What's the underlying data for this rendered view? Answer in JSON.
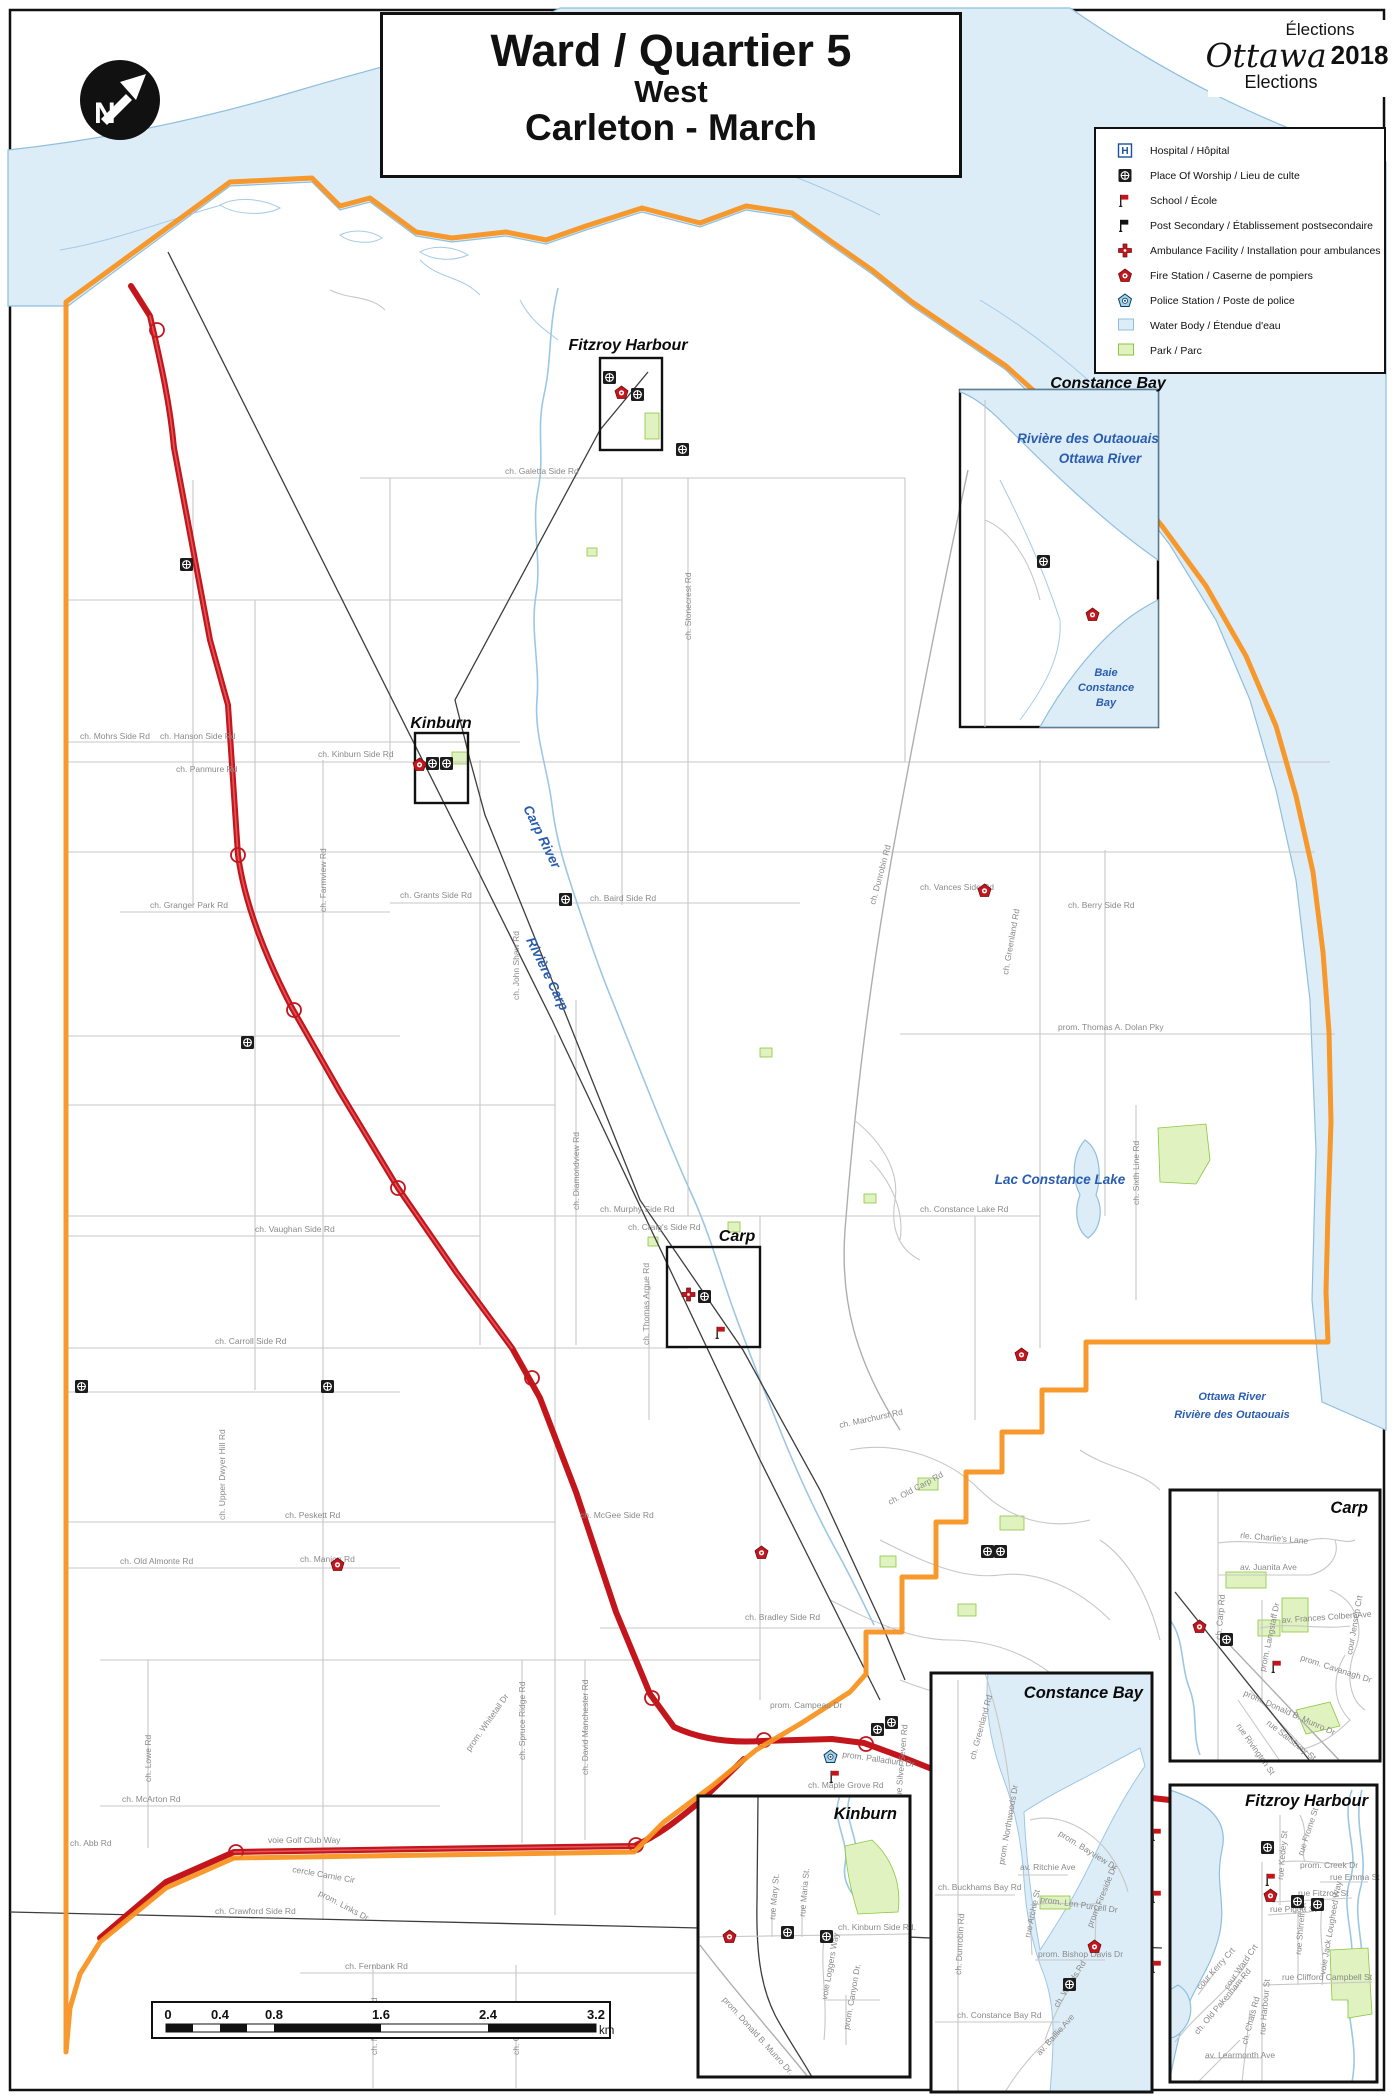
{
  "title": {
    "line1": "Ward / Quartier 5",
    "line2": "West",
    "line3": "Carleton - March"
  },
  "logo": {
    "elections_fr": "Élections",
    "brand": "Ottawa",
    "year": "2018",
    "elections_en": "Elections"
  },
  "legend": {
    "items": [
      {
        "id": "hospital",
        "label": "Hospital / Hôpital"
      },
      {
        "id": "worship",
        "label": "Place Of Worship / Lieu de culte"
      },
      {
        "id": "school",
        "label": "School / École"
      },
      {
        "id": "postsecondary",
        "label": "Post Secondary / Établissement postsecondaire"
      },
      {
        "id": "ambulance",
        "label": "Ambulance Facility / Installation pour ambulances"
      },
      {
        "id": "fire",
        "label": "Fire Station / Caserne de pompiers"
      },
      {
        "id": "police",
        "label": "Police Station / Poste de police"
      },
      {
        "id": "waterbody",
        "label": "Water Body / Étendue d'eau"
      },
      {
        "id": "park",
        "label": "Park / Parc"
      }
    ]
  },
  "scale_bar": {
    "ticks": [
      "0",
      "0.4",
      "0.8",
      "1.6",
      "2.4",
      "3.2"
    ],
    "unit": "km"
  },
  "colors": {
    "ward_boundary": "#F79421",
    "highway": "#C3161C",
    "water_fill": "#DCEDF8",
    "water_line": "#8FBFDD",
    "park_fill": "#DFF2BF",
    "park_stroke": "#8CC63F",
    "water_label": "#2A5CAF",
    "road_label": "#8a8a8a"
  },
  "map": {
    "settlement_labels": [
      {
        "t": "Fitzroy Harbour",
        "x": 628,
        "y": 350,
        "a": "middle"
      },
      {
        "t": "Constance Bay",
        "x": 1108,
        "y": 388,
        "a": "middle"
      },
      {
        "t": "Kinburn",
        "x": 441,
        "y": 728,
        "a": "middle"
      },
      {
        "t": "Carp",
        "x": 737,
        "y": 1241,
        "a": "middle"
      }
    ],
    "water_labels": [
      {
        "t": "Rivière des Outaouais",
        "x": 1088,
        "y": 443,
        "c": "wl-md",
        "a": "middle"
      },
      {
        "t": "Ottawa River",
        "x": 1100,
        "y": 463,
        "c": "wl-md",
        "a": "middle"
      },
      {
        "t": "Baie",
        "x": 1106,
        "y": 676,
        "c": "wl-sm",
        "a": "middle"
      },
      {
        "t": "Constance",
        "x": 1106,
        "y": 691,
        "c": "wl-sm",
        "a": "middle"
      },
      {
        "t": "Bay",
        "x": 1106,
        "y": 706,
        "c": "wl-sm",
        "a": "middle"
      },
      {
        "t": "Carp River",
        "x": 523,
        "y": 808,
        "c": "wl-md",
        "r": 64
      },
      {
        "t": "Rivière Carp",
        "x": 526,
        "y": 940,
        "c": "wl-md",
        "r": 64
      },
      {
        "t": "Lac  Constance Lake",
        "x": 1060,
        "y": 1184,
        "c": "wl-md",
        "a": "middle"
      },
      {
        "t": "Ottawa River",
        "x": 1232,
        "y": 1400,
        "c": "wl-sm",
        "a": "middle"
      },
      {
        "t": "Rivière des Outaouais",
        "x": 1232,
        "y": 1418,
        "c": "wl-sm",
        "a": "middle"
      }
    ],
    "road_labels": [
      {
        "t": "ch. Galetta Side Rd",
        "x": 505,
        "y": 474
      },
      {
        "t": "ch. Mohrs Side Rd",
        "x": 80,
        "y": 739
      },
      {
        "t": "ch. Hanson Side Rd",
        "x": 160,
        "y": 739
      },
      {
        "t": "ch. Panmure Rd",
        "x": 176,
        "y": 772
      },
      {
        "t": "ch. Kinburn Side Rd",
        "x": 318,
        "y": 757
      },
      {
        "t": "ch. Stonecrest Rd",
        "x": 691,
        "y": 640,
        "r": -90
      },
      {
        "t": "ch. Granger Park Rd",
        "x": 150,
        "y": 908
      },
      {
        "t": "ch. Farmview Rd",
        "x": 326,
        "y": 912,
        "r": -90
      },
      {
        "t": "ch. Grants Side Rd",
        "x": 400,
        "y": 898
      },
      {
        "t": "ch. Baird Side Rd",
        "x": 590,
        "y": 901
      },
      {
        "t": "ch. John Shaw Rd",
        "x": 519,
        "y": 1000,
        "r": -90
      },
      {
        "t": "ch. Diamondview Rd",
        "x": 579,
        "y": 1210,
        "r": -90
      },
      {
        "t": "ch. Dunrobin Rd",
        "x": 875,
        "y": 905,
        "r": -75
      },
      {
        "t": "ch. Vances Side Rd",
        "x": 920,
        "y": 890
      },
      {
        "t": "ch. Greenland Rd",
        "x": 1008,
        "y": 975,
        "r": -80
      },
      {
        "t": "ch. Berry Side Rd",
        "x": 1068,
        "y": 908
      },
      {
        "t": "prom. Thomas A. Dolan Pky",
        "x": 1058,
        "y": 1030
      },
      {
        "t": "ch. Murphy Side Rd",
        "x": 600,
        "y": 1212
      },
      {
        "t": "ch. Constance Lake Rd",
        "x": 920,
        "y": 1212
      },
      {
        "t": "ch. Sixth Line Rd",
        "x": 1139,
        "y": 1205,
        "r": -90
      },
      {
        "t": "ch. Vaughan Side Rd",
        "x": 255,
        "y": 1232
      },
      {
        "t": "ch. Carroll Side Rd",
        "x": 215,
        "y": 1344
      },
      {
        "t": "ch. Thomas Argue Rd",
        "x": 649,
        "y": 1345,
        "r": -90
      },
      {
        "t": "ch. Craig's Side Rd",
        "x": 628,
        "y": 1230
      },
      {
        "t": "ch. Upper Dwyer Hill Rd",
        "x": 225,
        "y": 1520,
        "r": -90
      },
      {
        "t": "ch. Peskett Rd",
        "x": 285,
        "y": 1518
      },
      {
        "t": "ch. Manion Rd",
        "x": 300,
        "y": 1562
      },
      {
        "t": "ch. Old Almonte Rd",
        "x": 120,
        "y": 1564
      },
      {
        "t": "ch. McGee Side Rd",
        "x": 580,
        "y": 1518
      },
      {
        "t": "ch. Old Carp Rd",
        "x": 890,
        "y": 1505,
        "r": -28
      },
      {
        "t": "ch. Marchurst Rd",
        "x": 840,
        "y": 1428,
        "r": -12
      },
      {
        "t": "ch. Bradley Side Rd",
        "x": 745,
        "y": 1620
      },
      {
        "t": "prom. Campeau Dr",
        "x": 770,
        "y": 1708
      },
      {
        "t": "prom. Palladium Dr",
        "x": 842,
        "y": 1757,
        "r": 8
      },
      {
        "t": "ch. Maple Grove Rd",
        "x": 808,
        "y": 1788
      },
      {
        "t": "rue Silver Seven Rd",
        "x": 901,
        "y": 1800,
        "r": -85
      },
      {
        "t": "ch. Lowe Rd",
        "x": 151,
        "y": 1782,
        "r": -90
      },
      {
        "t": "ch. McArton Rd",
        "x": 122,
        "y": 1802
      },
      {
        "t": "ch. Abb Rd",
        "x": 70,
        "y": 1846
      },
      {
        "t": "voie Golf Club Way",
        "x": 268,
        "y": 1843
      },
      {
        "t": "prom. Whitetail Dr",
        "x": 470,
        "y": 1752,
        "r": -55
      },
      {
        "t": "ch. Spruce Ridge Rd",
        "x": 525,
        "y": 1760,
        "r": -90
      },
      {
        "t": "ch. David Manchester Rd",
        "x": 588,
        "y": 1775,
        "r": -90
      },
      {
        "t": "cercle Carnie Cir",
        "x": 292,
        "y": 1872,
        "r": 10
      },
      {
        "t": "prom. Links Dr",
        "x": 318,
        "y": 1895,
        "r": 28
      },
      {
        "t": "ch. Crawford Side Rd",
        "x": 215,
        "y": 1914
      },
      {
        "t": "ch. Fernbank Rd",
        "x": 345,
        "y": 1969
      },
      {
        "t": "ch. Munster Rd",
        "x": 377,
        "y": 2055,
        "r": -90
      },
      {
        "t": "ch. Conley Rd",
        "x": 519,
        "y": 2055,
        "r": -90
      }
    ],
    "insets": [
      {
        "name": "Carp",
        "road_labels": [
          {
            "t": "rle. Charlie's Lane",
            "x": 1240,
            "y": 1538,
            "r": 5
          },
          {
            "t": "av. Juanita Ave",
            "x": 1240,
            "y": 1570
          },
          {
            "t": "av. Frances Colbert Ave",
            "x": 1282,
            "y": 1623,
            "r": -4
          },
          {
            "t": "prom. Cavanagh Dr",
            "x": 1300,
            "y": 1660,
            "r": 18
          },
          {
            "t": "cour Jensen Crt",
            "x": 1352,
            "y": 1655,
            "r": -80
          },
          {
            "t": "ch. Carp Rd",
            "x": 1221,
            "y": 1640,
            "r": -85
          },
          {
            "t": "prom. Langstaff Dr",
            "x": 1265,
            "y": 1672,
            "r": -78
          },
          {
            "t": "prom. Donald B. Munro Dr",
            "x": 1243,
            "y": 1695,
            "r": 24
          },
          {
            "t": "rue Salisbury St",
            "x": 1266,
            "y": 1724,
            "r": 38
          },
          {
            "t": "rue Rivington St",
            "x": 1236,
            "y": 1726,
            "r": 55
          }
        ]
      },
      {
        "name": "Fitzroy Harbour",
        "road_labels": [
          {
            "t": "rue Frome St",
            "x": 1303,
            "y": 1856,
            "r": -72
          },
          {
            "t": "rue Kedey St",
            "x": 1283,
            "y": 1880,
            "r": -85
          },
          {
            "t": "prom. Creek Dr",
            "x": 1300,
            "y": 1868
          },
          {
            "t": "rue Emma St",
            "x": 1330,
            "y": 1880
          },
          {
            "t": "rue Fitzroy St",
            "x": 1298,
            "y": 1896
          },
          {
            "t": "rue Pigott St",
            "x": 1270,
            "y": 1912
          },
          {
            "t": "rue Shirreff St",
            "x": 1301,
            "y": 1955,
            "r": -85
          },
          {
            "t": "voie Jack Lougheed Way",
            "x": 1325,
            "y": 1975,
            "r": -80
          },
          {
            "t": "rue Clifford Campbell St",
            "x": 1282,
            "y": 1980
          },
          {
            "t": "cour Kerry Crt",
            "x": 1200,
            "y": 1990,
            "r": -48
          },
          {
            "t": "cour Ward Crt",
            "x": 1228,
            "y": 1990,
            "r": -55
          },
          {
            "t": "ch. Old Pakenham Rd",
            "x": 1198,
            "y": 2035,
            "r": -50
          },
          {
            "t": "ch. Chats Rd",
            "x": 1247,
            "y": 2045,
            "r": -75
          },
          {
            "t": "rue Harbour St",
            "x": 1265,
            "y": 2035,
            "r": -85
          },
          {
            "t": "av. Learmonth Ave",
            "x": 1205,
            "y": 2058
          }
        ]
      },
      {
        "name": "Constance Bay",
        "road_labels": [
          {
            "t": "ch. Greenland Rd",
            "x": 975,
            "y": 1760,
            "r": -75
          },
          {
            "t": "prom. Northwoods Dr",
            "x": 1004,
            "y": 1865,
            "r": -80
          },
          {
            "t": "prom. Bayview Dr",
            "x": 1058,
            "y": 1835,
            "r": 32
          },
          {
            "t": "av. Ritchie Ave",
            "x": 1020,
            "y": 1870
          },
          {
            "t": "ch. Buckhams Bay Rd",
            "x": 938,
            "y": 1890
          },
          {
            "t": "prom. Len Purcell Dr",
            "x": 1040,
            "y": 1902,
            "r": 8
          },
          {
            "t": "rue Archie St",
            "x": 1030,
            "y": 1938,
            "r": -78
          },
          {
            "t": "prom. Fireside Dr",
            "x": 1092,
            "y": 1928,
            "r": -68
          },
          {
            "t": "prom. Bishop Davis Dr",
            "x": 1038,
            "y": 1957
          },
          {
            "t": "ch. Dunrobin Rd",
            "x": 961,
            "y": 1975,
            "r": -87
          },
          {
            "t": "ch. Woods Rd",
            "x": 1058,
            "y": 2008,
            "r": -58
          },
          {
            "t": "ch. Constance Bay Rd",
            "x": 957,
            "y": 2018
          },
          {
            "t": "av. Baillie Ave",
            "x": 1040,
            "y": 2056,
            "r": -48
          }
        ]
      },
      {
        "name": "Kinburn",
        "road_labels": [
          {
            "t": "rue Mary St.",
            "x": 775,
            "y": 1920,
            "r": -85
          },
          {
            "t": "rue Maria St.",
            "x": 805,
            "y": 1917,
            "r": -85
          },
          {
            "t": "ch. Kinburn Side Rd.",
            "x": 838,
            "y": 1930
          },
          {
            "t": "voie Loggers Way",
            "x": 827,
            "y": 2000,
            "r": -80
          },
          {
            "t": "prom. Canyon Dr.",
            "x": 849,
            "y": 2030,
            "r": -80
          },
          {
            "t": "prom. Donald B. Munro Dr.",
            "x": 722,
            "y": 2000,
            "r": 48
          }
        ]
      }
    ],
    "facilities": [
      {
        "type": "worship",
        "x": 603,
        "y": 371
      },
      {
        "type": "worship",
        "x": 631,
        "y": 388
      },
      {
        "type": "worship",
        "x": 426,
        "y": 757
      },
      {
        "type": "worship",
        "x": 440,
        "y": 757
      },
      {
        "type": "worship",
        "x": 698,
        "y": 1290
      },
      {
        "type": "worship",
        "x": 559,
        "y": 893
      },
      {
        "type": "worship",
        "x": 676,
        "y": 443
      },
      {
        "type": "worship",
        "x": 1037,
        "y": 555
      },
      {
        "type": "worship",
        "x": 180,
        "y": 558
      },
      {
        "type": "worship",
        "x": 75,
        "y": 1380
      },
      {
        "type": "worship",
        "x": 321,
        "y": 1380
      },
      {
        "type": "worship",
        "x": 241,
        "y": 1036
      },
      {
        "type": "worship",
        "x": 981,
        "y": 1545
      },
      {
        "type": "worship",
        "x": 994,
        "y": 1545
      },
      {
        "type": "worship",
        "x": 871,
        "y": 1723
      },
      {
        "type": "worship",
        "x": 885,
        "y": 1716
      },
      {
        "type": "fire",
        "x": 615,
        "y": 386
      },
      {
        "type": "fire",
        "x": 413,
        "y": 758
      },
      {
        "type": "fire",
        "x": 1086,
        "y": 608
      },
      {
        "type": "fire",
        "x": 978,
        "y": 884
      },
      {
        "type": "fire",
        "x": 1015,
        "y": 1348
      },
      {
        "type": "fire",
        "x": 755,
        "y": 1546
      },
      {
        "type": "fire",
        "x": 331,
        "y": 1558
      },
      {
        "type": "ambulance",
        "x": 682,
        "y": 1288
      },
      {
        "type": "police",
        "x": 824,
        "y": 1750
      },
      {
        "type": "school",
        "x": 715,
        "y": 1326
      },
      {
        "type": "school",
        "x": 829,
        "y": 1770
      },
      {
        "type": "school",
        "x": 1151,
        "y": 1828
      },
      {
        "type": "school",
        "x": 1151,
        "y": 1890
      },
      {
        "type": "school",
        "x": 1151,
        "y": 1960
      },
      {
        "type": "fire",
        "x": 1193,
        "y": 1620
      },
      {
        "type": "worship",
        "x": 1220,
        "y": 1633
      },
      {
        "type": "school",
        "x": 1271,
        "y": 1660
      },
      {
        "type": "worship",
        "x": 1261,
        "y": 1841
      },
      {
        "type": "school",
        "x": 1265,
        "y": 1873
      },
      {
        "type": "fire",
        "x": 1264,
        "y": 1889
      },
      {
        "type": "worship",
        "x": 1291,
        "y": 1895
      },
      {
        "type": "worship",
        "x": 1311,
        "y": 1898
      },
      {
        "type": "fire",
        "x": 1088,
        "y": 1940
      },
      {
        "type": "worship",
        "x": 1063,
        "y": 1978
      },
      {
        "type": "fire",
        "x": 723,
        "y": 1930
      },
      {
        "type": "worship",
        "x": 781,
        "y": 1926
      },
      {
        "type": "worship",
        "x": 820,
        "y": 1930
      }
    ]
  }
}
